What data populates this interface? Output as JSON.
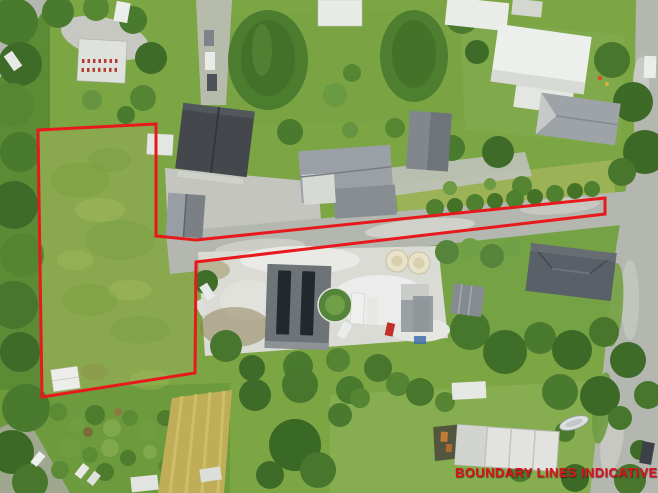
{
  "overlay": {
    "disclaimer_text": "BOUNDARY LINES INDICATIVE O",
    "disclaimer_color": "#dc1220"
  },
  "boundary": {
    "color": "#e8191c",
    "stroke_width": "3",
    "lot_points": "38,130 156,124 156,236 196,240 605,198 605,214 196,262 195,373 42,397",
    "field_points": "38,130 156,124 156,236 196,240 196,262 195,373 42,397",
    "shape": "large grass paddock at left with long narrow access strip running right to the road"
  },
  "scene": {
    "description": "aerial drone photo of semi-rural residential properties",
    "palette": {
      "base_green": "#7ca544",
      "field_green": "#8aa94e",
      "orchard_green": "#6d9a3d",
      "lawn_green": "#7aa344",
      "dry_grass": "#9cb257",
      "tree_dark": "#3f6b28",
      "tree_mid": "#4a7a2e",
      "tree_light": "#659340",
      "road_gray": "#b4b7b0",
      "concrete": "#c3c5be",
      "gravel_light": "#d9dbd4",
      "roof_dark": "#44484c",
      "roof_gray": "#9aa0a5",
      "roof_white": "#edefec",
      "tank_cream": "#e9e2cb",
      "tan_field": "#bfae57",
      "solar_panel": "#23282d"
    },
    "features": [
      "farmyard with greenhouses top-left",
      "two large conifer trees top-center",
      "houses with dark and white roofs along middle",
      "shared gravel driveway strip outlined in red",
      "rural yard with shed, solar-panel roof, two cream tanks and parked vehicles",
      "hip-roof house right of yard",
      "vertical road along right edge",
      "orchard and tan mown strip bottom-left",
      "house under construction bottom-right",
      "small white shed inside paddock"
    ]
  }
}
